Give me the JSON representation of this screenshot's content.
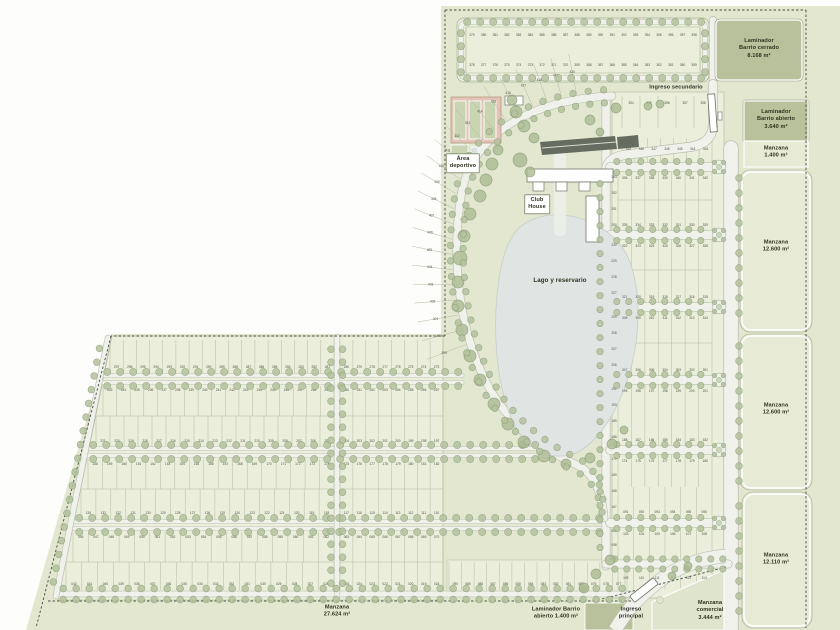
{
  "palette": {
    "plan_bg": "#e3e7d0",
    "lot_fill": "#eaeeda",
    "dark_block": "#b9c19c",
    "manzana_block": "#e7ebd6",
    "lake": "#e0e5e4",
    "road": "#f1f1ec",
    "road_casing": "#bcc1b0",
    "tree_fill": "#b4c29e",
    "tree_stroke": "#8da17b",
    "parking": "#666c60",
    "court_pink": "#e3c4b6",
    "court_green": "#c9d4b2",
    "dash_line": "#4a4f44",
    "label_text": "#2d331f",
    "lot_number": "#4d5444"
  },
  "labels": {
    "laminador_cerrado": [
      "Laminador",
      "Barrio cerrado",
      "8.168 m²"
    ],
    "ingreso_secundario": [
      "Ingreso secundario"
    ],
    "laminador_abierto_norte": [
      "Laminador",
      "Barrio abierto",
      "3.640 m²"
    ],
    "manzana_1400_norte": [
      "Manzana",
      "1.400 m²"
    ],
    "manzana_12600_a": [
      "Manzana",
      "12.600 m²"
    ],
    "manzana_12600_b": [
      "Manzana",
      "12.600 m²"
    ],
    "manzana_12110": [
      "Manzana",
      "12.110 m²"
    ],
    "manzana_27624": [
      "Manzana",
      "27.624 m²"
    ],
    "laminador_abierto_sur": [
      "Laminador Barrio",
      "abierto 1.400 m²"
    ],
    "ingreso_principal": [
      "Ingreso",
      "principal"
    ],
    "manzana_comercial": [
      "Manzana",
      "comercial",
      "3.444 m²"
    ],
    "area_deportivo": [
      "Área",
      "deportivo"
    ],
    "club_house": [
      "Club",
      "House"
    ],
    "lago": [
      "Lago y reservario"
    ]
  },
  "lots": {
    "rows": [
      {
        "x1": 466,
        "x2": 700,
        "yt": 27,
        "yb": 50,
        "ny": 36,
        "a": 379,
        "b": 398
      },
      {
        "x1": 466,
        "x2": 700,
        "yt": 50,
        "yb": 73,
        "ny": 66,
        "a": 378,
        "b": 359
      },
      {
        "x1": 110,
        "x2": 334,
        "yt": 340,
        "yb": 373,
        "ny": 368,
        "a": 297,
        "b": 281
      },
      {
        "x1": 340,
        "x2": 443,
        "yt": 340,
        "yb": 373,
        "ny": 368,
        "a": 280,
        "b": 273
      },
      {
        "x1": 103,
        "x2": 334,
        "yt": 386,
        "yb": 416,
        "ny": 391,
        "a": 233,
        "b": 249
      },
      {
        "x1": 340,
        "x2": 443,
        "yt": 386,
        "yb": 416,
        "ny": 391,
        "a": 250,
        "b": 257
      },
      {
        "x1": 96,
        "x2": 334,
        "yt": 416,
        "yb": 446,
        "ny": 442,
        "a": 221,
        "b": 205
      },
      {
        "x1": 340,
        "x2": 443,
        "yt": 416,
        "yb": 446,
        "ny": 442,
        "a": 204,
        "b": 197
      },
      {
        "x1": 88,
        "x2": 334,
        "yt": 459,
        "yb": 489,
        "ny": 465,
        "a": 158,
        "b": 174
      },
      {
        "x1": 340,
        "x2": 443,
        "yt": 459,
        "yb": 489,
        "ny": 465,
        "a": 175,
        "b": 182
      },
      {
        "x1": 81,
        "x2": 334,
        "yt": 489,
        "yb": 519,
        "ny": 514,
        "a": 134,
        "b": 118
      },
      {
        "x1": 340,
        "x2": 443,
        "yt": 489,
        "yb": 519,
        "ny": 514,
        "a": 117,
        "b": 110
      },
      {
        "x1": 73,
        "x2": 334,
        "yt": 532,
        "yb": 562,
        "ny": 538,
        "a": 46,
        "b": 62
      },
      {
        "x1": 340,
        "x2": 443,
        "yt": 532,
        "yb": 562,
        "ny": 538,
        "a": 63,
        "b": 70
      },
      {
        "x1": 66,
        "x2": 334,
        "yt": 562,
        "yb": 590,
        "ny": 585,
        "a": 42,
        "b": 26
      },
      {
        "x1": 340,
        "x2": 443,
        "yt": 562,
        "yb": 590,
        "ny": 585,
        "a": 25,
        "b": 18
      },
      {
        "x1": 449,
        "x2": 625,
        "yt": 562,
        "yb": 590,
        "ny": 585,
        "a": 90,
        "b": 77
      },
      {
        "x1": 622,
        "x2": 712,
        "yt": 96,
        "yb": 128,
        "ny": 104,
        "a": 354,
        "b": 358
      },
      {
        "x1": 622,
        "x2": 712,
        "yt": 138,
        "yb": 163,
        "ny": 150,
        "a": 349,
        "b": 343
      },
      {
        "x1": 618,
        "x2": 712,
        "yt": 172,
        "yb": 200,
        "ny": 179,
        "a": 336,
        "b": 342
      },
      {
        "x1": 618,
        "x2": 712,
        "yt": 200,
        "yb": 230,
        "ny": 226,
        "a": 335,
        "b": 329
      },
      {
        "x1": 618,
        "x2": 712,
        "yt": 240,
        "yb": 270,
        "ny": 247,
        "a": 322,
        "b": 328
      },
      {
        "x1": 618,
        "x2": 712,
        "yt": 270,
        "yb": 302,
        "ny": 298,
        "a": 321,
        "b": 315
      },
      {
        "x1": 618,
        "x2": 712,
        "yt": 312,
        "yb": 343,
        "ny": 319,
        "a": 308,
        "b": 314
      },
      {
        "x1": 618,
        "x2": 712,
        "yt": 343,
        "yb": 375,
        "ny": 371,
        "a": 307,
        "b": 301
      },
      {
        "x1": 618,
        "x2": 712,
        "yt": 385,
        "yb": 417,
        "ny": 392,
        "a": 195,
        "b": 201
      },
      {
        "x1": 618,
        "x2": 712,
        "yt": 417,
        "yb": 445,
        "ny": 441,
        "a": 188,
        "b": 182
      },
      {
        "x1": 618,
        "x2": 712,
        "yt": 455,
        "yb": 487,
        "ny": 462,
        "a": 174,
        "b": 180
      },
      {
        "x1": 618,
        "x2": 712,
        "yt": 487,
        "yb": 518,
        "ny": 513,
        "a": 91,
        "b": 96
      },
      {
        "x1": 618,
        "x2": 712,
        "yt": 528,
        "yb": 559,
        "ny": 535,
        "a": 103,
        "b": 108
      },
      {
        "x1": 618,
        "x2": 712,
        "yt": 569,
        "yb": 590,
        "ny": 579,
        "a": 109,
        "b": 114
      }
    ],
    "stacks": [
      {
        "x": 614,
        "y0": 178,
        "step": 16,
        "a": 253,
        "b": 250
      },
      {
        "x": 614,
        "y0": 246,
        "step": 16,
        "a": 230,
        "b": 227
      },
      {
        "x": 614,
        "y0": 318,
        "step": 16,
        "a": 209,
        "b": 206
      },
      {
        "x": 614,
        "y0": 390,
        "step": 16,
        "a": 191,
        "b": 188
      },
      {
        "x": 614,
        "y0": 460,
        "step": 16,
        "a": 170,
        "b": 167
      },
      {
        "x": 614,
        "y0": 532,
        "step": 14,
        "a": 99,
        "b": 97
      }
    ],
    "radial": {
      "start": 420,
      "end": 399,
      "t0": 0.06,
      "t1": 0.6
    }
  }
}
